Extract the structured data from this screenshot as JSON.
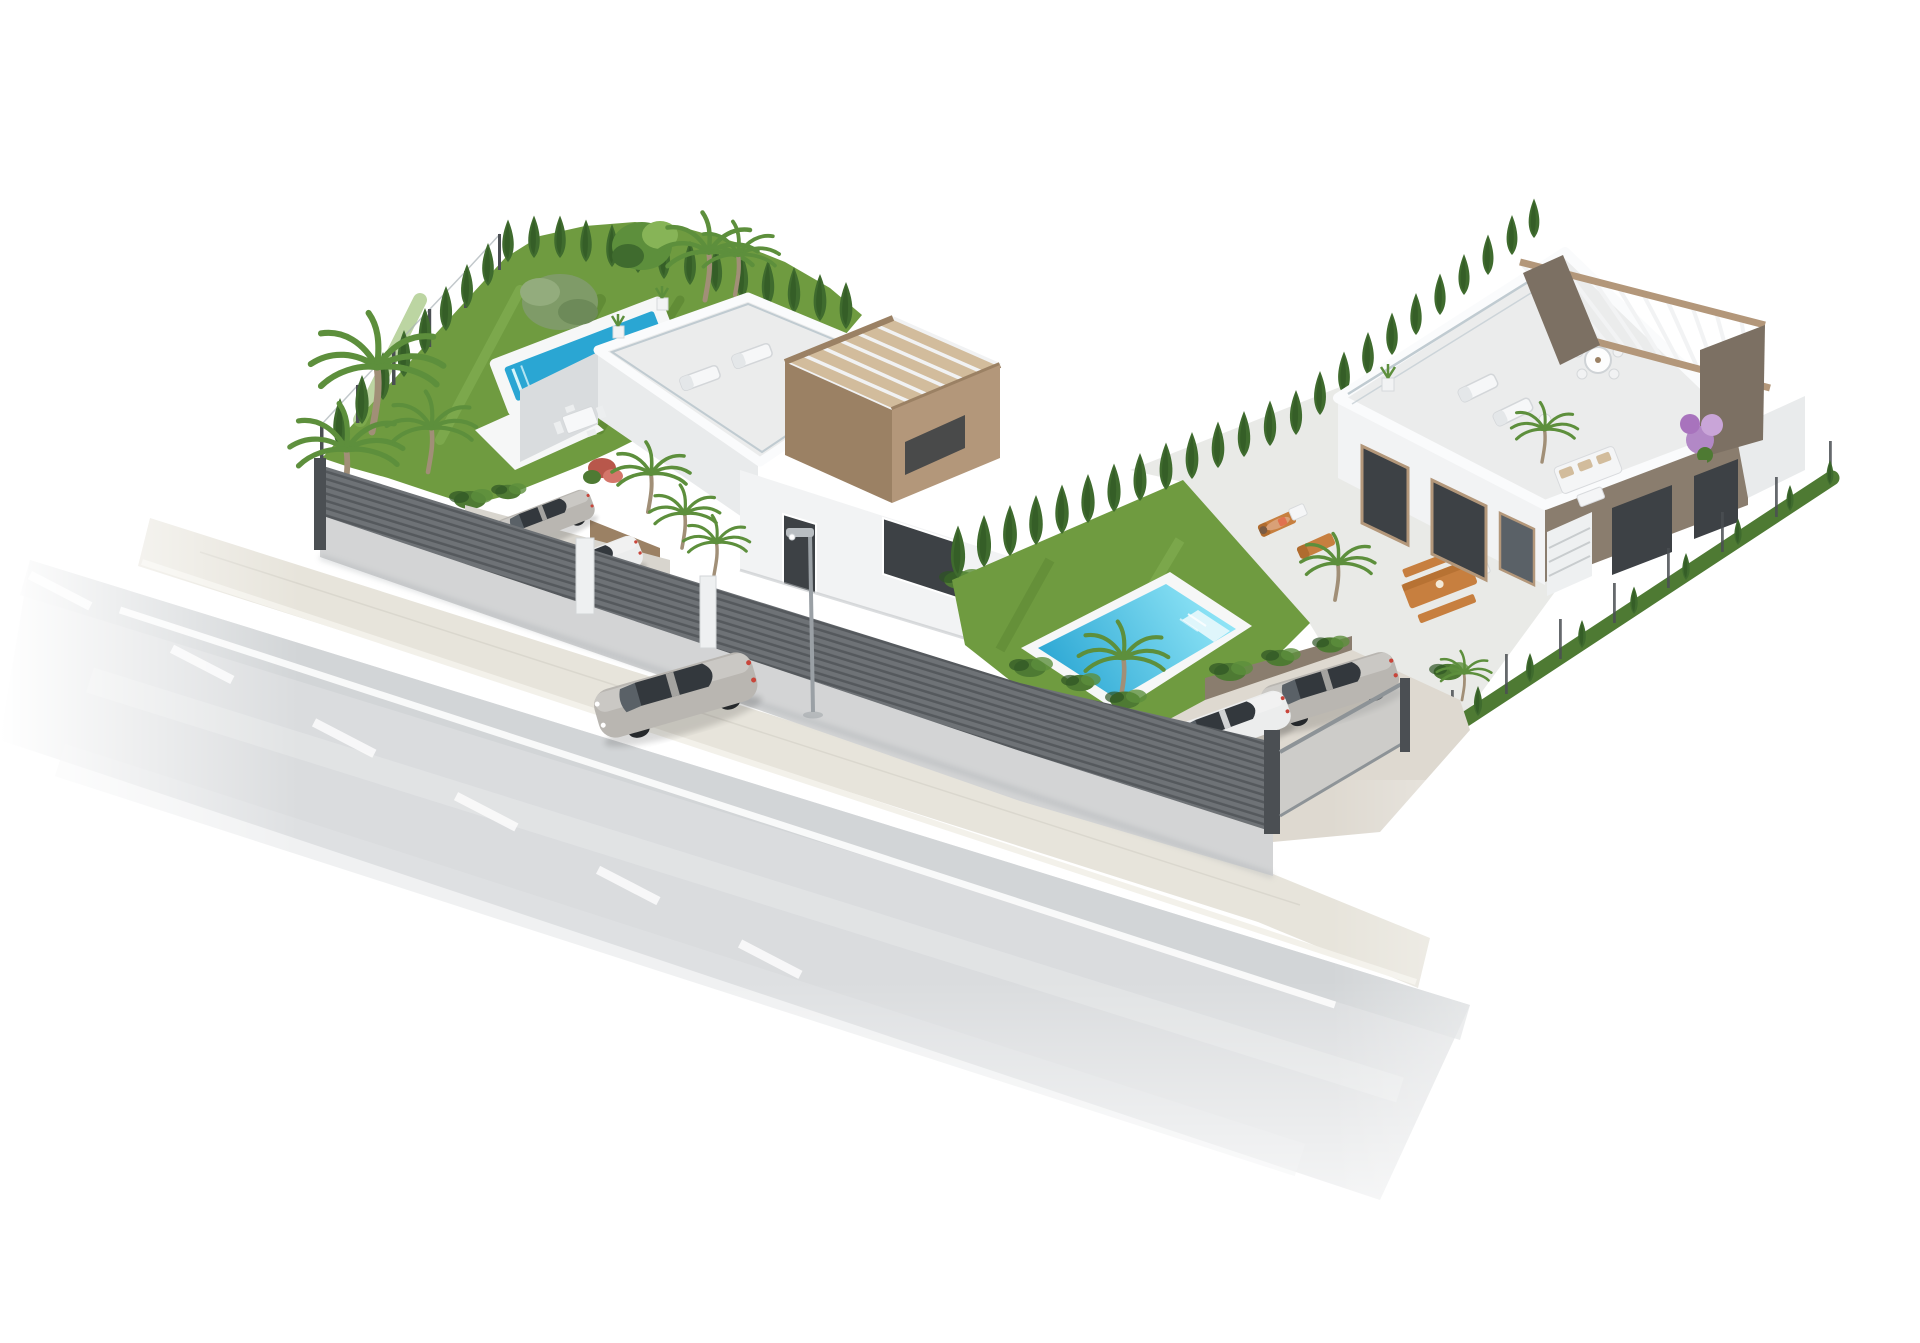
{
  "scene": {
    "type": "3d-architectural-render",
    "setting": "aerial view of two modern white villas with gardens and pools beside a road, isolated on white",
    "left_villa": {
      "floors": 2,
      "roof_terrace": true,
      "pergola_tower": true,
      "lap_pool": true,
      "parked_cars": 2,
      "garden": "large lawn with palms, olive tree and cypress hedge"
    },
    "right_villa": {
      "floors": 1,
      "roof_terrace": true,
      "pergola": true,
      "garden_pool": true,
      "parked_cars": 2,
      "terrace_furniture": [
        "sun loungers",
        "wooden dining table with benches",
        "round table with chairs",
        "outdoor sofa"
      ]
    },
    "street": {
      "driving_cars": 1,
      "lamp_posts": 1,
      "markings": [
        "solid white line",
        "dashed white line"
      ],
      "fence": "dark horizontal-slat fence on concrete base"
    }
  },
  "palette": {
    "road": "#dadcde",
    "roadLine": "#fbfbfb",
    "sidewalk": "#e7e4db",
    "curb": "#f3f1ea",
    "fenceSlat": "#6e7276",
    "fenceSlatDark": "#55595d",
    "fenceBase": "#d3d4d5",
    "fencePost": "#4b4f53",
    "lawn": "#6f9b40",
    "lawnLight": "#87b457",
    "lawnDark": "#57802f",
    "cypress": "#3f6b2e",
    "cypressDark": "#2e5423",
    "bush": "#4e7a33",
    "palmGreen": "#5d8f3c",
    "trunk": "#a18f77",
    "olive": "#7f9b68",
    "poolDeck": "#f6f7f7",
    "poolDeep": "#2aa6d3",
    "poolLight": "#8ee4f6",
    "wallWhite": "#f2f3f4",
    "wallLight": "#e9ebec",
    "wallShade": "#d9dcde",
    "parapet": "#fafbfc",
    "roofFloor": "#ebecec",
    "tan": "#b3977a",
    "tanLight": "#d2bc9c",
    "tanDark": "#9b8164",
    "taupe": "#8a7d6e",
    "taupeDark": "#7c7063",
    "windowDark": "#3d4145",
    "glassMid": "#5a6167",
    "carSilver": "#b9b6b1",
    "carWhite": "#eceded",
    "carGlass": "#33383d",
    "wood": "#c77f3f",
    "woodDark": "#b06c2f",
    "purple": "#b288c6",
    "skin": "#d9a077",
    "railing": "#c0cbd1",
    "lampPole": "#9aa0a5"
  }
}
